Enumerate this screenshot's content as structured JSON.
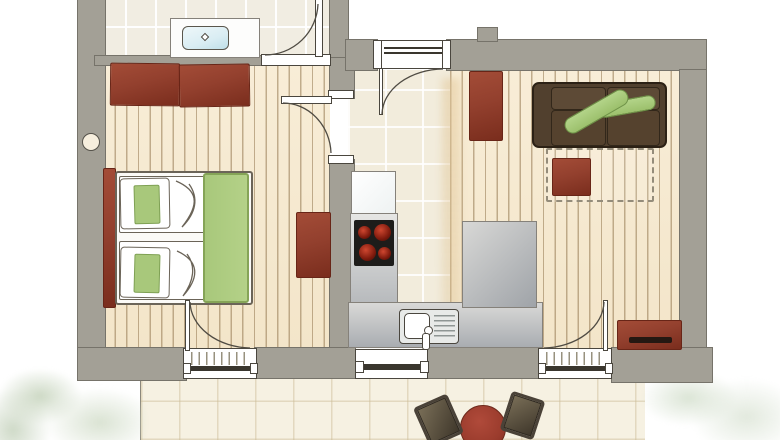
{
  "plan": {
    "title": "apartment-floor-plan",
    "rooms": {
      "bathroom": {
        "label": "Bathroom",
        "furniture": [
          "vanity-with-basin"
        ]
      },
      "bedroom": {
        "label": "Bedroom",
        "furniture": [
          "wardrobe",
          "double-bed",
          "dresser"
        ]
      },
      "hall_kitchen": {
        "label": "Hall / Kitchen",
        "furniture": [
          "tall-appliance",
          "cooktop-counter",
          "sink-counter",
          "peninsula-counter"
        ]
      },
      "living_room": {
        "label": "Living Room",
        "furniture": [
          "tall-cabinet",
          "sofa",
          "bolster-cushions",
          "rug",
          "coffee-table",
          "sideboard"
        ]
      },
      "terrace": {
        "label": "Terrace",
        "furniture": [
          "round-table",
          "chair-left",
          "chair-right"
        ]
      }
    },
    "doors": [
      "entrance-door",
      "bathroom-door",
      "bedroom-door",
      "bedroom-terrace-door",
      "living-terrace-door",
      "kitchen-window"
    ],
    "colors": {
      "wall": "#a3a096",
      "wall_outline": "#76736a",
      "wood_floor": "#f8edd7",
      "tile_floor": "#f1ede2",
      "terrace_floor": "#f6f1e2",
      "red": "#93402e",
      "red_dark": "#682517",
      "sofa_brown": "#51402e",
      "sofa_outline": "#2c2115",
      "cushion_green": "#9cc06c",
      "bed_green": "#a8c87b",
      "counter_gray": "#c6c9cb",
      "cooktop_black": "#1d1c1a",
      "burner_red": "#cf4730",
      "sink_blue": "#d9edf3",
      "line": "#4a463e",
      "garden_green": "#dfe7da"
    }
  }
}
